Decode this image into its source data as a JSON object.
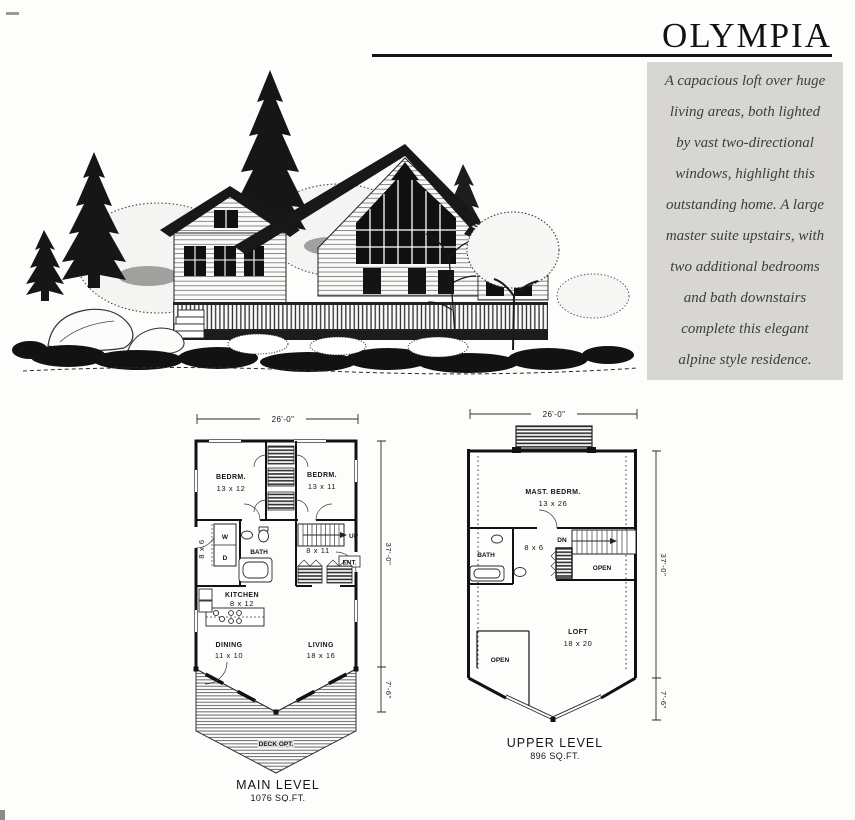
{
  "page": {
    "title": "OLYMPIA",
    "description_lines": [
      "A capacious loft over huge",
      "living areas, both lighted",
      "by vast two-directional",
      "windows, highlight this",
      "outstanding home. A large",
      "master suite upstairs, with",
      "two additional bedrooms",
      "and bath downstairs",
      "complete this elegant",
      "alpine style residence."
    ]
  },
  "main_level": {
    "dim_width": "26'-0\"",
    "dim_height": "37'-0\"",
    "dim_deck": "7'-6\"",
    "bedroom1_name": "BEDRM.",
    "bedroom1_size": "13 x 12",
    "bedroom2_name": "BEDRM.",
    "bedroom2_size": "13 x 11",
    "laundry_size": "8 x 6",
    "washer": "W",
    "dryer": "D",
    "bath": "BATH",
    "stairs_up": "UP",
    "hall_size": "8 x 11",
    "entry": "ENT.",
    "kitchen_name": "KITCHEN",
    "kitchen_size": "8 x 12",
    "dining_name": "DINING",
    "dining_size": "11 x 10",
    "living_name": "LIVING",
    "living_size": "18 x 16",
    "deck": "DECK OPT.",
    "level_label": "MAIN LEVEL",
    "level_area": "1076 SQ.FT."
  },
  "upper_level": {
    "dim_width": "26'-0\"",
    "dim_height": "37'-0\"",
    "dim_deck": "7'-6\"",
    "master_name": "MAST. BEDRM.",
    "master_size": "13 x 26",
    "bath": "BATH",
    "hall_size": "8 x 6",
    "stairs_dn": "DN",
    "open_stair": "OPEN",
    "loft_name": "LOFT",
    "loft_size": "18 x 20",
    "open_below": "OPEN",
    "level_label": "UPPER LEVEL",
    "level_area": "896 SQ.FT."
  }
}
